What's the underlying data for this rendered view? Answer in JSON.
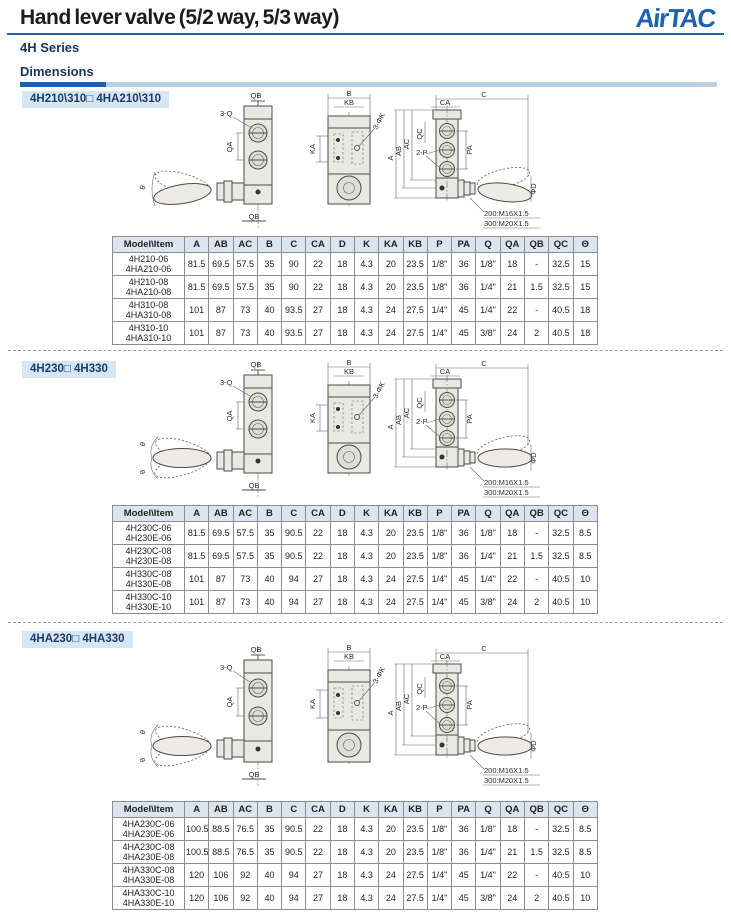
{
  "header": {
    "title": "Hand lever valve (5/2 way, 5/3 way)",
    "logo": "AirTAC",
    "series": "4H Series",
    "section_title": "Dimensions"
  },
  "colors": {
    "brand_blue": "#1b62b0",
    "navy_text": "#17365d",
    "chip_background": "#d7e6f3",
    "table_header_background": "#dbe5ef",
    "drawing_fill": "#e9e9e3"
  },
  "drawing_labels": {
    "QB": "QB",
    "threeQ": "3-Q",
    "QA": "QA",
    "theta": "θ",
    "B": "B",
    "KB": "KB",
    "KA": "KA",
    "threePhiK": "3-ΦK",
    "C": "C",
    "CA": "CA",
    "A": "A",
    "AB": "AB",
    "AC": "AC",
    "QC": "QC",
    "twoP": "2-P",
    "PA": "PA",
    "phiD": "ΦD",
    "thread200": "200:M16X1.5",
    "thread300": "300:M20X1.5"
  },
  "table": {
    "headers": [
      "Model\\Item",
      "A",
      "AB",
      "AC",
      "B",
      "C",
      "CA",
      "D",
      "K",
      "KA",
      "KB",
      "P",
      "PA",
      "Q",
      "QA",
      "QB",
      "QC",
      "Θ"
    ]
  },
  "sections": [
    {
      "label": "4H210\\310□ 4HA210\\310",
      "rows": [
        {
          "models": [
            "4H210-06",
            "4HA210-06"
          ],
          "values": [
            "81.5",
            "69.5",
            "57.5",
            "35",
            "90",
            "22",
            "18",
            "4.3",
            "20",
            "23.5",
            "1/8\"",
            "36",
            "1/8\"",
            "18",
            "-",
            "32.5",
            "15"
          ]
        },
        {
          "models": [
            "4H210-08",
            "4HA210-08"
          ],
          "values": [
            "81.5",
            "69.5",
            "57.5",
            "35",
            "90",
            "22",
            "18",
            "4.3",
            "20",
            "23.5",
            "1/8\"",
            "36",
            "1/4\"",
            "21",
            "1.5",
            "32.5",
            "15"
          ]
        },
        {
          "models": [
            "4H310-08",
            "4HA310-08"
          ],
          "values": [
            "101",
            "87",
            "73",
            "40",
            "93.5",
            "27",
            "18",
            "4.3",
            "24",
            "27.5",
            "1/4\"",
            "45",
            "1/4\"",
            "22",
            "-",
            "40.5",
            "18"
          ]
        },
        {
          "models": [
            "4H310-10",
            "4HA310-10"
          ],
          "values": [
            "101",
            "87",
            "73",
            "40",
            "93.5",
            "27",
            "18",
            "4.3",
            "24",
            "27.5",
            "1/4\"",
            "45",
            "3/8\"",
            "24",
            "2",
            "40.5",
            "18"
          ]
        }
      ]
    },
    {
      "label": "4H230□ 4H330",
      "rows": [
        {
          "models": [
            "4H230C-06",
            "4H230E-06"
          ],
          "values": [
            "81.5",
            "69.5",
            "57.5",
            "35",
            "90.5",
            "22",
            "18",
            "4.3",
            "20",
            "23.5",
            "1/8\"",
            "36",
            "1/8\"",
            "18",
            "-",
            "32.5",
            "8.5"
          ]
        },
        {
          "models": [
            "4H230C-08",
            "4H230E-08"
          ],
          "values": [
            "81.5",
            "69.5",
            "57.5",
            "35",
            "90.5",
            "22",
            "18",
            "4.3",
            "20",
            "23.5",
            "1/8\"",
            "36",
            "1/4\"",
            "21",
            "1.5",
            "32.5",
            "8.5"
          ]
        },
        {
          "models": [
            "4H330C-08",
            "4H330E-08"
          ],
          "values": [
            "101",
            "87",
            "73",
            "40",
            "94",
            "27",
            "18",
            "4.3",
            "24",
            "27.5",
            "1/4\"",
            "45",
            "1/4\"",
            "22",
            "-",
            "40.5",
            "10"
          ]
        },
        {
          "models": [
            "4H330C-10",
            "4H330E-10"
          ],
          "values": [
            "101",
            "87",
            "73",
            "40",
            "94",
            "27",
            "18",
            "4.3",
            "24",
            "27.5",
            "1/4\"",
            "45",
            "3/8\"",
            "24",
            "2",
            "40.5",
            "10"
          ]
        }
      ]
    },
    {
      "label": "4HA230□ 4HA330",
      "rows": [
        {
          "models": [
            "4HA230C-06",
            "4HA230E-06"
          ],
          "values": [
            "100.5",
            "88.5",
            "76.5",
            "35",
            "90.5",
            "22",
            "18",
            "4.3",
            "20",
            "23.5",
            "1/8\"",
            "36",
            "1/8\"",
            "18",
            "-",
            "32.5",
            "8.5"
          ]
        },
        {
          "models": [
            "4HA230C-08",
            "4HA230E-08"
          ],
          "values": [
            "100.5",
            "88.5",
            "76.5",
            "35",
            "90.5",
            "22",
            "18",
            "4.3",
            "20",
            "23.5",
            "1/8\"",
            "36",
            "1/4\"",
            "21",
            "1.5",
            "32.5",
            "8.5"
          ]
        },
        {
          "models": [
            "4HA330C-08",
            "4HA330E-08"
          ],
          "values": [
            "120",
            "106",
            "92",
            "40",
            "94",
            "27",
            "18",
            "4.3",
            "24",
            "27.5",
            "1/4\"",
            "45",
            "1/4\"",
            "22",
            "-",
            "40.5",
            "10"
          ]
        },
        {
          "models": [
            "4HA330C-10",
            "4HA330E-10"
          ],
          "values": [
            "120",
            "106",
            "92",
            "40",
            "94",
            "27",
            "18",
            "4.3",
            "24",
            "27.5",
            "1/4\"",
            "45",
            "3/8\"",
            "24",
            "2",
            "40.5",
            "10"
          ]
        }
      ]
    }
  ]
}
